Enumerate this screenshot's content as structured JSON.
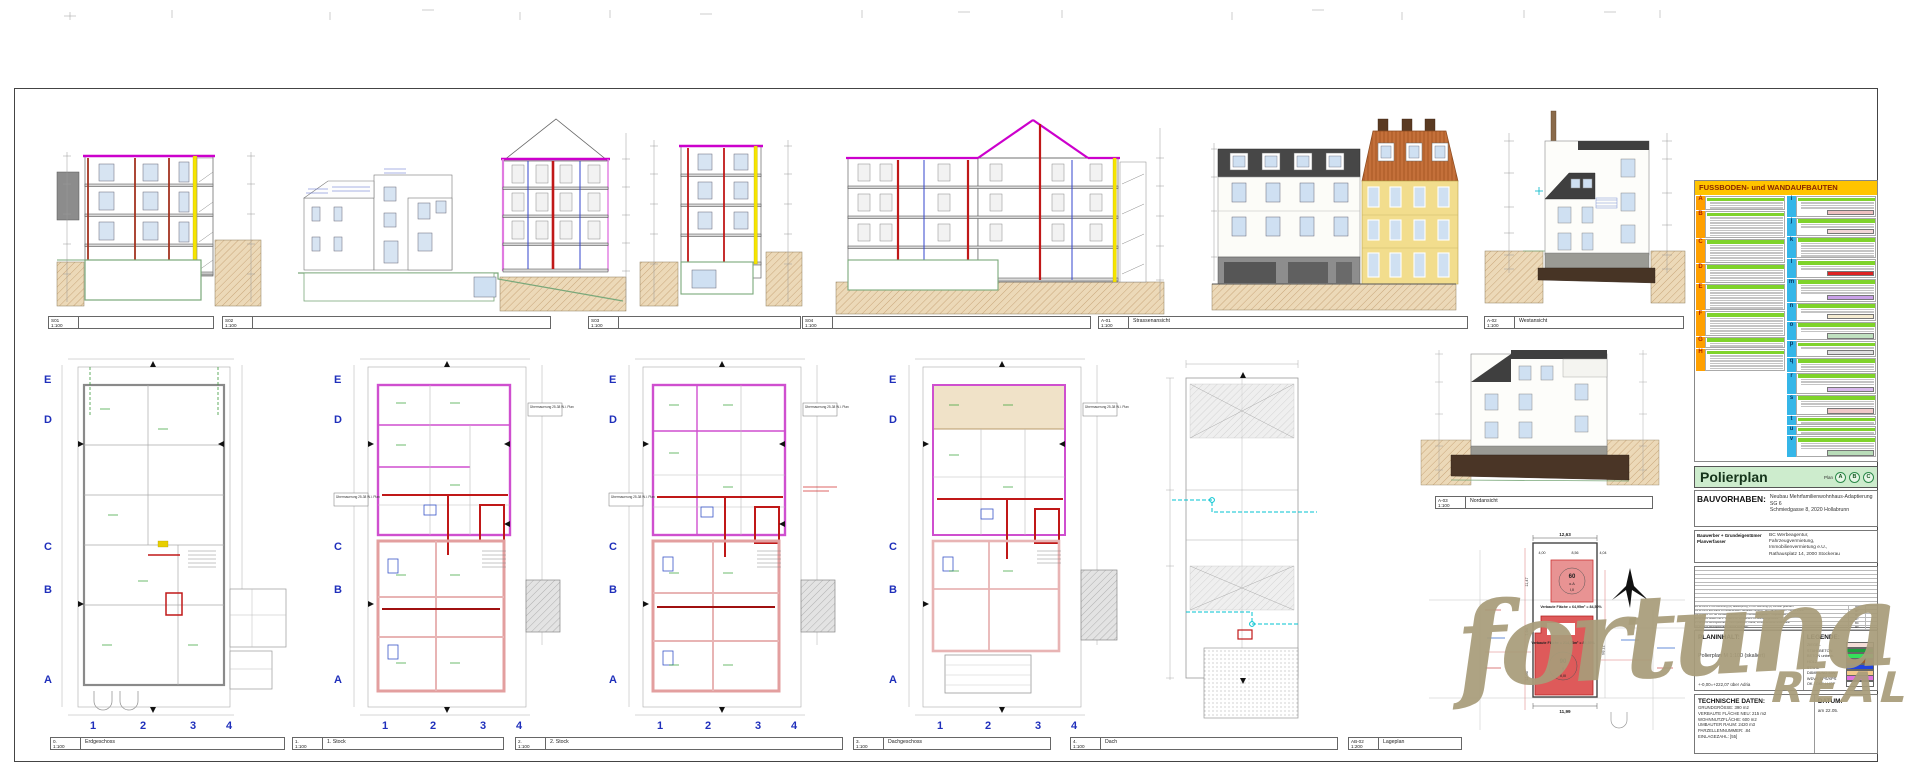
{
  "top_labels": [
    {
      "id": "S01",
      "scale": "1:100",
      "name": ""
    },
    {
      "id": "S02",
      "scale": "1:100",
      "name": ""
    },
    {
      "id": "S03",
      "scale": "1:100",
      "name": ""
    },
    {
      "id": "S04",
      "scale": "1:100",
      "name": ""
    },
    {
      "id": "A-01",
      "scale": "1:100",
      "name": "Strassenansicht"
    },
    {
      "id": "A-02",
      "scale": "1:100",
      "name": "Westansicht"
    }
  ],
  "mid_label": {
    "id": "A-03",
    "scale": "1:100",
    "name": "Nordansicht"
  },
  "bottom_labels": [
    {
      "id": "0.",
      "scale": "1:100",
      "name": "Erdgeschoss"
    },
    {
      "id": "1.",
      "scale": "1:100",
      "name": "1. Stock"
    },
    {
      "id": "2.",
      "scale": "1:100",
      "name": "2. Stock"
    },
    {
      "id": "3.",
      "scale": "1:100",
      "name": "Dachgeschoss"
    },
    {
      "id": "4.",
      "scale": "1:100",
      "name": "Dach"
    },
    {
      "id": "AB-02",
      "scale": "1:200",
      "name": "Lageplan"
    }
  ],
  "grid": {
    "letters": [
      "E",
      "D",
      "C",
      "B",
      "A"
    ],
    "numbers": [
      "1",
      "2",
      "3",
      "4"
    ]
  },
  "note": {
    "uebermauerung": "Übermauerung\n25-38 W.i. Plan"
  },
  "legend_table": {
    "title": "FUSSBODEN- und WANDAUFBAUTEN",
    "left_letters": [
      "A",
      "B",
      "C",
      "D",
      "E",
      "F",
      "G",
      "H"
    ],
    "right_letters": [
      "i",
      "j",
      "k",
      "l",
      "m",
      "n",
      "o",
      "p",
      "q",
      "r",
      "s",
      "t",
      "u",
      "v"
    ],
    "swatches": {
      "i": "#eec0c0",
      "j": "#f2d6d6",
      "l": "#dd2222",
      "m": "#c9a0e8",
      "n": "#f5ecd2",
      "o": "#bfe0bf",
      "p": "#e0e0e0",
      "r": "#d8b8ec",
      "s": "#f0c8c8",
      "v": "#b8dcb8"
    }
  },
  "titleblock": {
    "plan_title": "Polierplan",
    "plan_word": "Plan",
    "markers": [
      "A",
      "B",
      "C"
    ],
    "bauvorhaben_label": "BAUVORHABEN:",
    "bauvorhaben_text": "Neubau Mehrfamilienwohnhaus-Adaptierung SG 6\nSchmiedgasse 8, 2020 Hollabrunn",
    "owner_label": "Bauwerber + Grundeigentümer\nPlanverfasser",
    "owner_text": "BC Werbeagentur,\nFahrzeugvermietung,\nImmobilienvermietung e.U.,\nRathausplatz 14, 2000 Stockerau",
    "revisions": [
      {
        "text": "22.11.2015  1.OG Wohnung (A) Bekämpfung, 2.OG Wohnung (A) Fenster geändert",
        "name": "BT",
        "index": ""
      },
      {
        "text": "09.11.2015  EG-Rand zu bestehendem Gebäude versetzt, Technikraum +5cm, OB/16 5,5cm",
        "name": "BT",
        "index": ""
      },
      {
        "text": "09.11.2015  OK SB Fenster geändert (unten Fensterausgleiten / Tiegelfenster)",
        "name": "BT",
        "index": ""
      },
      {
        "text": "02.11.2015  Mauer bei o. Schacht im Fundament zu Bestandsgebäude",
        "name": "BT",
        "index": ""
      },
      {
        "text": "27.11.2015  Aufzugsschacht Türen geändert, Kanal, Fundamentanschluss Statik",
        "name": "BC",
        "index": "C"
      },
      {
        "text": "02.11.2015  Aufzugsschacht Größe verändert",
        "name": "BT",
        "index": ""
      },
      {
        "text": "27.10.2015  Bodenöffnung, Schachtbrut (Dämmung), Deckenbeläge",
        "name": "BT",
        "index": "B"
      },
      {
        "text": "07.10.2015  Fundamentierungen Aufbauten, Stiegenhaus-Breite/Wände, Portal ergänzt",
        "name": "BC",
        "index": ""
      },
      {
        "text": "05.10.2015  OK Geschosshöhe, Maße eingearbeitet, Dämmung Süd Decke 70, Roste, HKLS Weg",
        "name": "BC",
        "index": "A"
      },
      {
        "text": "28.01.2015  Fußbodenaufbau Systemschnitt ergänzt",
        "name": "BL",
        "index": ""
      },
      {
        "text": "26.01.2015  Polierplanstand Erstübermittlung an Statiker",
        "name": "BL",
        "index": ""
      }
    ],
    "rev_footer": {
      "datum": "Datum",
      "aenderung": "Änderung",
      "name": "Name",
      "index": "Index"
    },
    "planinhalt": {
      "label": "PLANINHALT:",
      "text": "Polierplan M 1:100 (skaliert)",
      "adria": "+-0,00=+222,07 über Adria"
    },
    "legende": {
      "label": "LEGENDE:",
      "items": [
        {
          "name": "ZIEGEL",
          "color": "#f5ded8"
        },
        {
          "name": "STAHLBETON",
          "color": "#1e9e3e"
        },
        {
          "name": "BETON unbew.",
          "color": "#35e05a"
        },
        {
          "name": "HOLZ",
          "color": "#9a5b2a"
        },
        {
          "name": "STAHL",
          "color": "#2244dd"
        },
        {
          "name": "DÄMMUNG MW",
          "color": "#f3c98a"
        },
        {
          "name": "WDVS EPS/XPS",
          "color": "#df72df"
        },
        {
          "name": "OK / OKF / HOF",
          "color": "#ffffff"
        }
      ]
    },
    "technische": {
      "label": "TECHNISCHE DATEN:",
      "rows": [
        "GRUNDGRÖSSE:  390 m2",
        "VERBAUTE FLÄCHE NEU:  215 m2",
        "WOHNNUTZFLÄCHE:  600 m2",
        "UMBAUTER RAUM:  2420 m3",
        "PARZELLENNUMMER:  .84",
        "EINLAGEZAHL:  [55]"
      ]
    },
    "datum": {
      "label": "DATUM:",
      "text": "am 22.05."
    }
  },
  "lageplan": {
    "dim_top": "12,63",
    "dim_a": "4,00",
    "dim_b": "8,56",
    "dim_c": "4,04",
    "dim_l1": "11,47",
    "dim_l2": "7,94",
    "dim_l3": "12,06",
    "dim_r": "27,94",
    "dim_bottom": "11,99",
    "upper": {
      "big": "60",
      "mid": "o.A",
      "small": "I,II",
      "area": "Verbaute Fläche = 64,95m² = 84,50%"
    },
    "lower": {
      "big": "90",
      "mid": "9",
      "small": "II,III",
      "area": "Verbaute Fläche = 214,73m² = 84,36%"
    }
  },
  "watermark": {
    "line1": "fortuna",
    "line2": "REAL"
  }
}
